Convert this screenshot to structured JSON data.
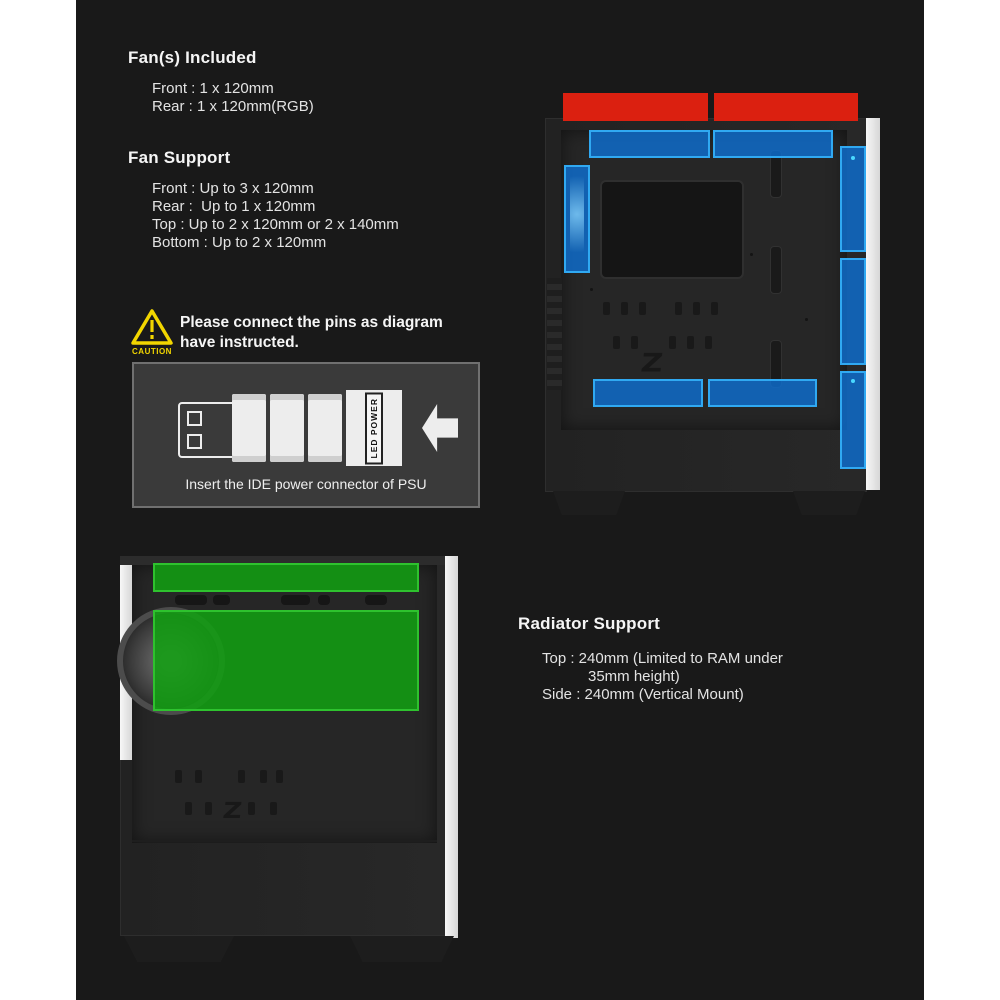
{
  "fans_included": {
    "title": "Fan(s) Included",
    "items": [
      "Front : 1 x 120mm",
      "Rear : 1 x 120mm(RGB)"
    ]
  },
  "fan_support": {
    "title": "Fan Support",
    "items": [
      "Front : Up to 3 x 120mm",
      "Rear :  Up to 1 x 120mm",
      "Top : Up to 2 x 120mm or 2 x 140mm",
      "Bottom : Up to 2 x 120mm"
    ]
  },
  "caution": {
    "badge": "CAUTION",
    "line1": "Please connect the pins as diagram",
    "line2": "have instructed.",
    "connector_label": "LED POWER",
    "caption": "Insert the IDE power connector of PSU"
  },
  "radiator_support": {
    "title": "Radiator Support",
    "line1": "Top : 240mm (Limited to RAM under",
    "line2": "35mm height)",
    "line3": "Side : 240mm (Vertical Mount)"
  },
  "diagrams": {
    "top_case": {
      "brand_letter": "Z",
      "highlight_zones": {
        "top_exterior_red_rects": 2,
        "top_interior_blue_rects": 2,
        "rear_blue_fan": 1,
        "front_blue_fans": 3,
        "bottom_blue_rects": 2
      }
    },
    "bottom_case": {
      "brand_letter": "Z",
      "highlight_zones": {
        "top_green_radiator": 1,
        "side_green_radiator": 1
      }
    }
  },
  "colors": {
    "page_bg": "#ffffff",
    "panel_bg": "#191919",
    "highlight_red": "#db2010",
    "highlight_blue": "#0d72d8",
    "highlight_blue_border": "#30a9f2",
    "highlight_green": "#129e12",
    "highlight_green_border": "#2ec22e",
    "caution_yellow": "#f2d600",
    "text": "#e3e3e3"
  }
}
